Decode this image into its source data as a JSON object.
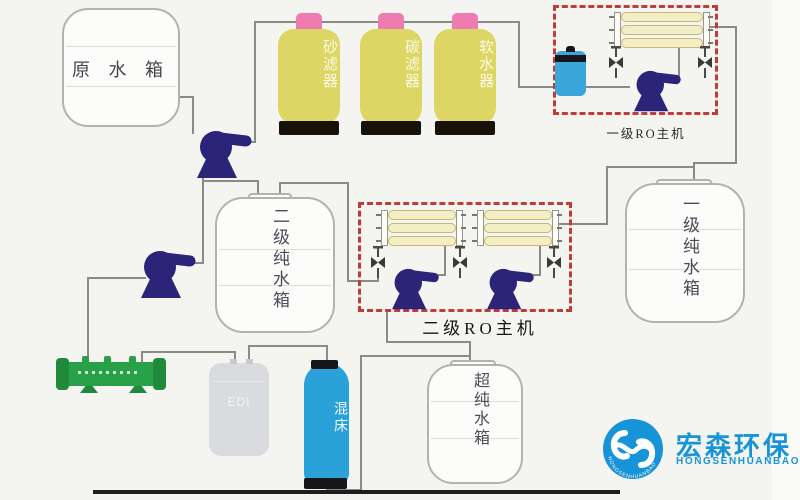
{
  "diagram": {
    "raw_tank": "原 水 箱",
    "sand_filter": "砂滤器",
    "carbon_filter": "碳滤器",
    "softener": "软水器",
    "ro_stage1": "一级RO主机",
    "ro_stage2": "二级RO主机",
    "pure1_tank": "一级纯水箱",
    "pure2_tank": "二级纯水箱",
    "ultra_tank": "超纯水箱",
    "edi_module": "EDI",
    "mixed_bed": "混床"
  },
  "logo": {
    "company_cn": "宏森环保",
    "company_en": "HONGSENHUANBAO",
    "ring_text": "HONGSENHUANBAO"
  },
  "colors": {
    "vessel_yellow": "#ddd664",
    "cap_pink": "#ee7cb2",
    "pump_navy": "#2c2478",
    "membrane_yellow": "#f4eec4",
    "ro_box_red": "#c23b3b",
    "mixed_bed_blue": "#2aa1d8",
    "uv_green": "#28a149",
    "logo_blue": "#1793d8",
    "pipe_gray": "#8a8a86"
  }
}
